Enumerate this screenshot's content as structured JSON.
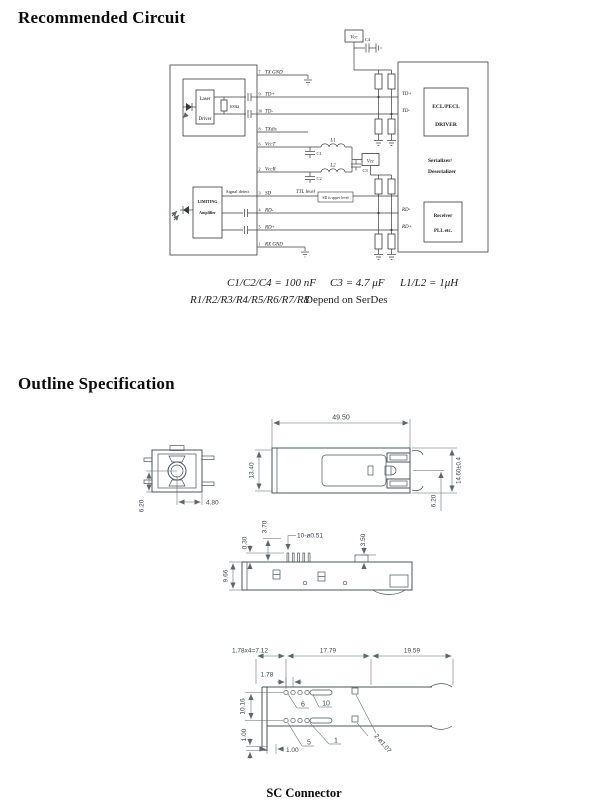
{
  "page": {
    "section1_title": "Recommended Circuit",
    "section2_title": "Outline Specification",
    "bottom_caption": "SC Connector"
  },
  "circuit": {
    "module": {
      "laser1": "Laser",
      "laser2": "Driver",
      "resistor": "100Ω",
      "amp1": "LIMITING",
      "amp2": "Amplifier",
      "signal_detect": "Signal detect"
    },
    "pins": [
      {
        "num": "7",
        "name": "TX GND"
      },
      {
        "num": "9",
        "name": "TD+"
      },
      {
        "num": "10",
        "name": "TD-"
      },
      {
        "num": "8",
        "name": "TXdis"
      },
      {
        "num": "6",
        "name": "VccT"
      },
      {
        "num": "2",
        "name": "VccR"
      },
      {
        "num": "3",
        "name": "SD"
      },
      {
        "num": "4",
        "name": "RD-"
      },
      {
        "num": "5",
        "name": "RD+"
      },
      {
        "num": "1",
        "name": "RX GND"
      }
    ],
    "filter": {
      "c1": "C1",
      "c2": "C2",
      "c3": "C3",
      "c4": "C4",
      "l1": "L1",
      "l2": "L2",
      "vcc_top": "Vcc",
      "vcc_mid": "Vcc"
    },
    "sd_note": {
      "ttl": "TTL level",
      "box": "SD is upper level"
    },
    "serdes": {
      "drv1": "ECL/PECL",
      "drv2": "DRIVER",
      "name1": "Serializer/",
      "name2": "Deserializer",
      "rx1": "Receiver",
      "rx2": "PLL etc.",
      "td_p": "TD+",
      "td_m": "TD-",
      "rd_m": "RD-",
      "rd_p": "RD+"
    },
    "notes": {
      "caps": "C1/C2/C4 = 100 nF",
      "c3": "C3 = 4.7 μF",
      "ind": "L1/L2 = 1μH",
      "res_list": "R1/R2/R3/R4/R5/R6/R7/R8",
      "res_note": "Depend on SerDes"
    }
  },
  "outline": {
    "front": {
      "h": "6.20",
      "w": "4.80"
    },
    "top": {
      "length": "49.50",
      "body": "13.40",
      "overall": "14.60±0.4",
      "port": "6.20"
    },
    "side": {
      "pin": "0.30",
      "lead": "3.70",
      "holes": "10-ø0.51",
      "tab": "3.50",
      "height": "9.66"
    },
    "bottom": {
      "pitch": "1.78x4=7.12",
      "mid": "17.79",
      "end": "19.59",
      "p1": "1.78",
      "rows": "10.16",
      "v100": "1.00",
      "h100": "1.00",
      "pin6": "6",
      "pin10": "10",
      "pin5": "5",
      "pin1": "1",
      "holes": "2-ø1.07"
    }
  }
}
